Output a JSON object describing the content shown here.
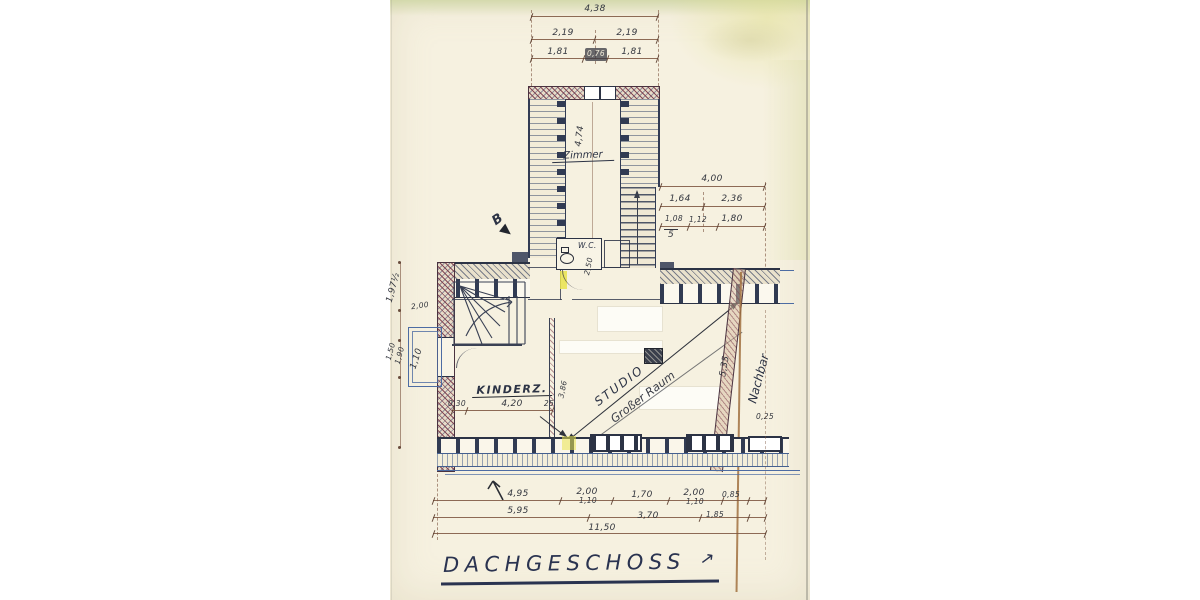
{
  "title": {
    "text": "DACHGESCHOSS",
    "arrow": "↗"
  },
  "rooms": {
    "zimmer": "Zimmer",
    "wc": "W.C.",
    "kinderzimmer": "KINDERZ.",
    "studio": "STUDIO",
    "grosser_raum": "Großer Raum"
  },
  "annotations": {
    "nachbar": "Nachbar",
    "section_letter": "B"
  },
  "dims": {
    "top_total": "4,38",
    "top_halves": [
      "2,19",
      "2,19"
    ],
    "top_parts": [
      "1,81",
      "0,76",
      "1,81"
    ],
    "zimmer_depth": "4,74",
    "right_total": "4,00",
    "right_row2": [
      "1,64",
      "2,36"
    ],
    "right_row3": [
      "1,08",
      "1,12",
      "1,80"
    ],
    "right_note": "5",
    "wc_depth": "2,50",
    "left_a": "1,97½",
    "left_b": "2,00",
    "left_c": "1,50",
    "left_d": "1,90",
    "balcony_width": "1,10",
    "kinder_wall": "0,30",
    "kinder_width": "4,20",
    "kinder_sep": "25",
    "partition_len": "3,86",
    "studio_depth": "5,35",
    "neighbor_thk": "0,25",
    "bottom_row1": [
      "4,95",
      "2,00",
      "1,70",
      "2,00",
      "0,85"
    ],
    "bottom_doors": [
      "1,10",
      "1,10"
    ],
    "bottom_row2": [
      "5,95",
      "3,70",
      "1,85"
    ],
    "bottom_total": "11,50"
  },
  "colors": {
    "paper": "#f6f1e0",
    "ink_blue": "#2c3345",
    "line_blue": "#4d6ca3",
    "wall_red": "#7c3b4a",
    "dim_brown": "#8a5a43",
    "pencil_gray": "#34373f",
    "highlight_yellow": "#e9e34c",
    "fold_brown": "#a1713f"
  }
}
